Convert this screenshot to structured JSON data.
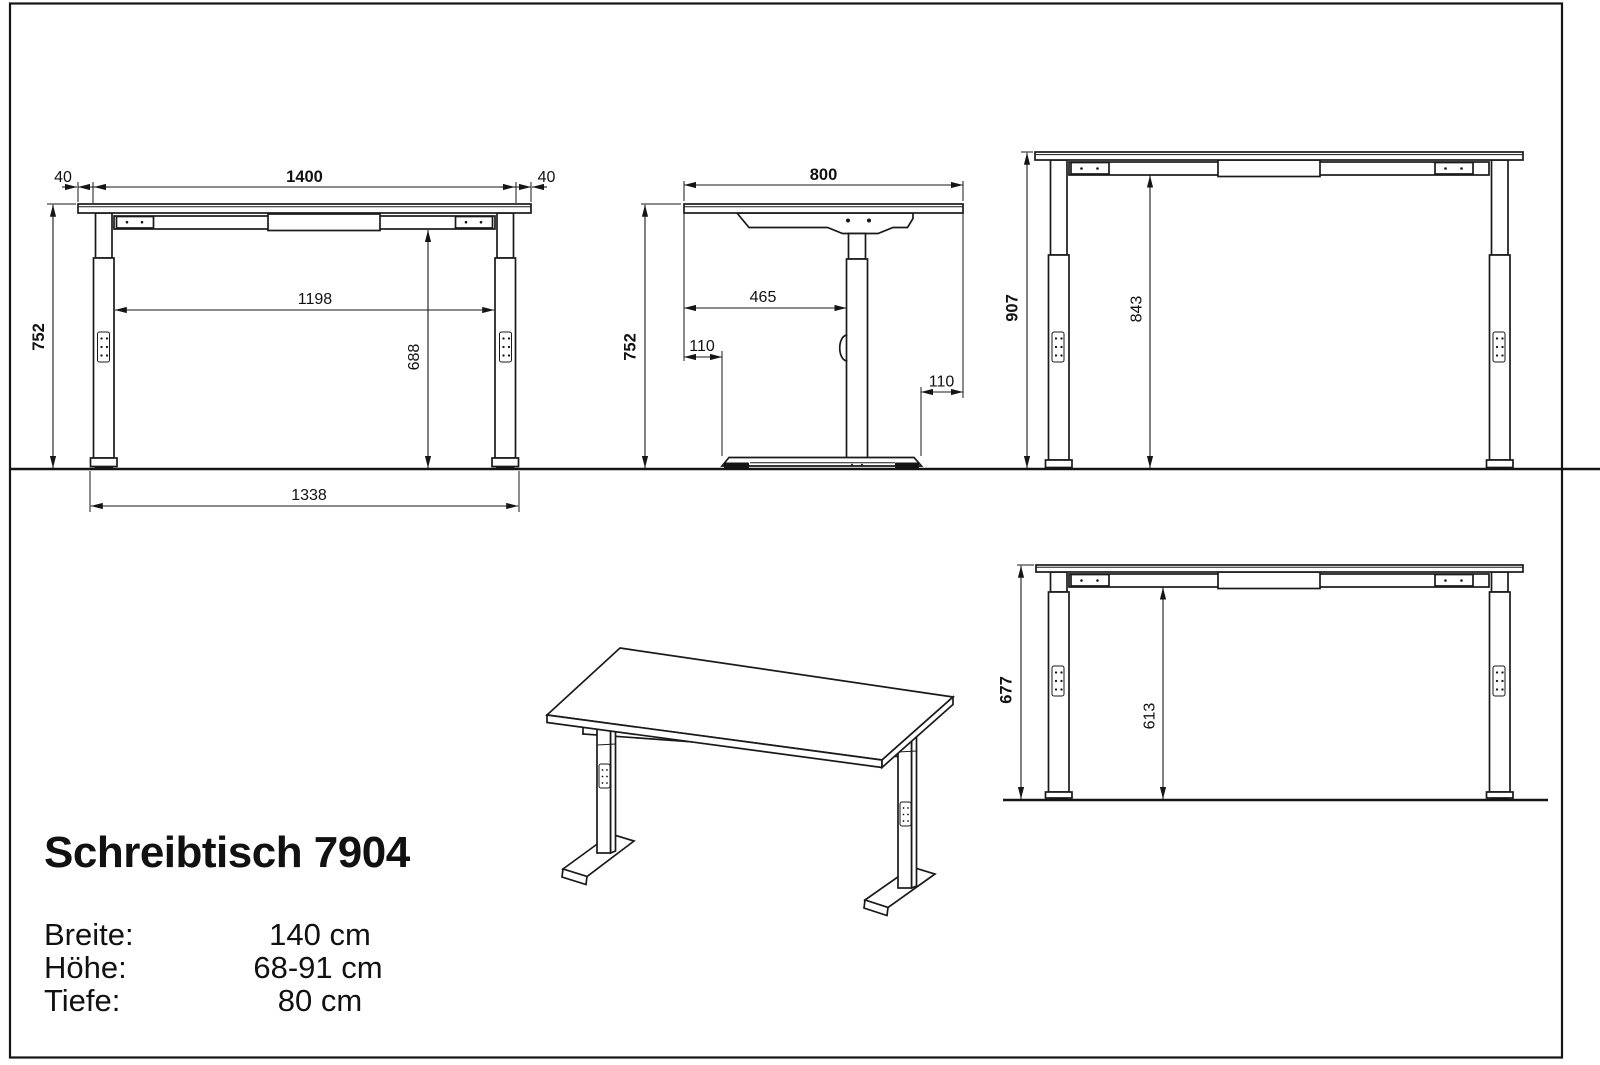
{
  "product": {
    "title": "Schreibtisch 7904"
  },
  "specs": [
    {
      "label": "Breite:",
      "value": "140 cm"
    },
    {
      "label": "Höhe:",
      "value": "68-91 cm"
    },
    {
      "label": "Tiefe:",
      "value": "80 cm"
    }
  ],
  "views": {
    "front": {
      "label_40_left": "40",
      "label_width": "1400",
      "label_40_right": "40",
      "label_height": "752",
      "label_inner_width": "1198",
      "label_clearance": "688",
      "label_foot_span": "1338"
    },
    "side": {
      "label_depth": "800",
      "label_height": "752",
      "label_setback": "465",
      "label_front_overhang": "110",
      "label_rear_overhang": "110"
    },
    "raised": {
      "label_height": "907",
      "label_clearance": "843"
    },
    "lowered": {
      "label_height": "677",
      "label_clearance": "613"
    }
  },
  "colors": {
    "line": "#1a1a1a",
    "background": "#ffffff"
  }
}
